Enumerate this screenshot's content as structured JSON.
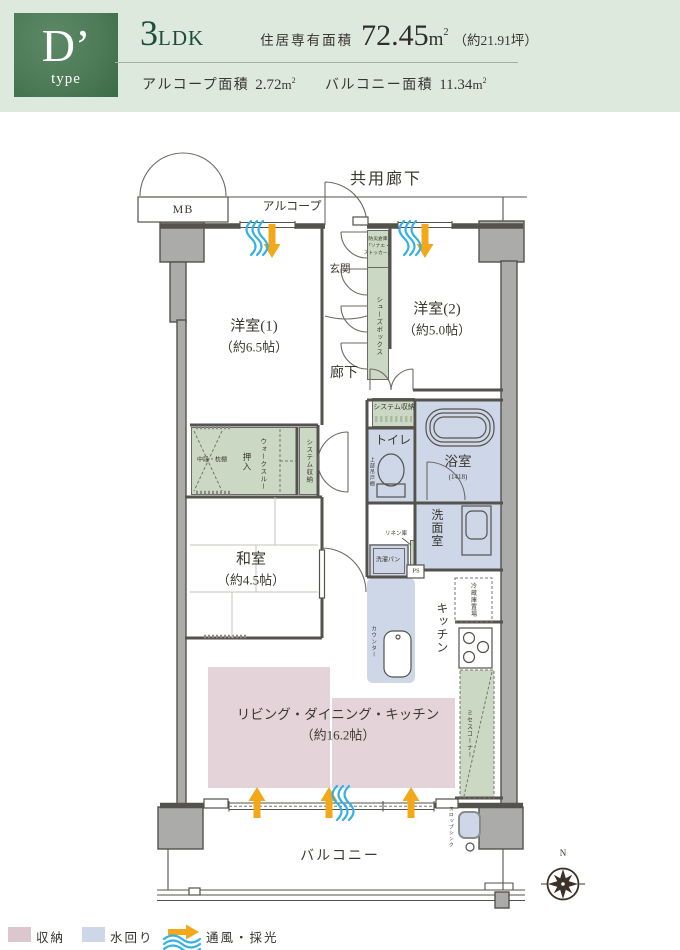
{
  "header": {
    "type_letter": "D’",
    "type_word": "type",
    "layout_number": "3",
    "layout_unit": "LDK",
    "area_label": "住居専有面積",
    "area_value": "72.45",
    "area_unit": "m",
    "area_sup": "2",
    "area_tsubo": "（約21.91坪）",
    "alcove_label": "アルコープ面積",
    "alcove_value": "2.72",
    "alcove_unit": "m",
    "alcove_sup": "2",
    "balcony_label": "バルコニー面積",
    "balcony_value": "11.34",
    "balcony_unit": "m",
    "balcony_sup": "2"
  },
  "plan": {
    "common_corridor": "共用廊下",
    "alcove": "アルコープ",
    "mb": "MB",
    "western1_name": "洋室(1)",
    "western1_size": "（約6.5帖）",
    "western2_name": "洋室(2)",
    "western2_size": "（約5.0帖）",
    "entrance": "玄関",
    "disaster_box_1": "防災倉庫",
    "disaster_box_2": "「ソナエ・",
    "disaster_box_3": "ストッカー」",
    "shoes_box": "シューズボックス",
    "corridor": "廊下",
    "system_storage_a": "システム収納",
    "system_storage_b": "システム収納",
    "toilet": "トイレ",
    "upper_cabinet": "上部吊戸棚",
    "bath": "浴室",
    "bath_size": "(1418)",
    "shelf": "中段・枕棚",
    "oshiire": "押入",
    "walkthrough": "ウォークスルー",
    "japanese_name": "和室",
    "japanese_size": "（約4.5帖）",
    "washroom": "洗面室",
    "linen": "リネン庫",
    "laundry_pan": "洗濯パン",
    "ps": "PS",
    "kitchen": "キッチン",
    "counter": "カウンター",
    "fridge_space": "冷蔵庫置場",
    "mrs_corner": "ミセスコーナー",
    "ldk_name": "リビング・ダイニング・キッチン",
    "ldk_size": "（約16.2帖）",
    "balcony": "バルコニー",
    "slop_sink": "スロップシンク",
    "north": "N"
  },
  "legend": {
    "storage": "収納",
    "water": "水回り",
    "ventilation": "通風・採光"
  },
  "colors": {
    "header_bg": "#dee9de",
    "badge_green": "#4e7b57",
    "accent_green": "#1d4e38",
    "text_dark": "#37352f",
    "wall": "#54524c",
    "pillar_gray": "#ababa9",
    "storage_green": "#cbd9c4",
    "water_blue": "#cdd7e7",
    "ldk_pink": "#e4d4da",
    "legend_pink": "#dcc7ce",
    "arrow_orange": "#f2a818",
    "wave_blue": "#33b1e4",
    "line_soft": "#8e8b85"
  }
}
